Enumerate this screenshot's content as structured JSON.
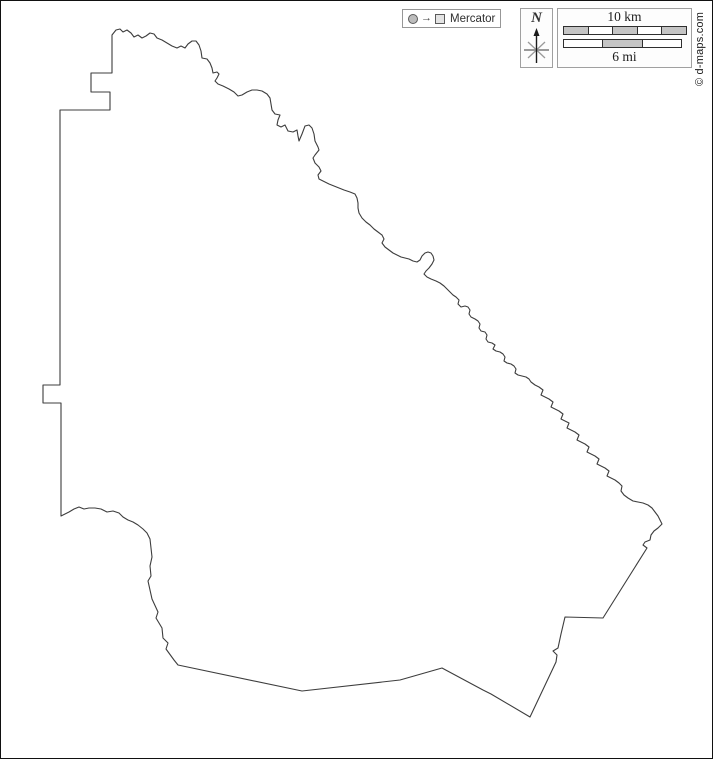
{
  "legend": {
    "projection": "Mercator",
    "arrow_glyph": "→"
  },
  "compass": {
    "label": "N"
  },
  "scale": {
    "km_label": "10 km",
    "mi_label": "6 mi",
    "km_segments": [
      "#c4c4c4",
      "#ffffff",
      "#c4c4c4",
      "#ffffff",
      "#c4c4c4"
    ],
    "mi_segments": [
      "#ffffff",
      "#c4c4c4",
      "#ffffff"
    ]
  },
  "copyright": "© d-maps.com",
  "colors": {
    "outline": "#3d3d3d",
    "frame": "#111111",
    "box_border": "#a0a0a0"
  },
  "map": {
    "outline_points": "112,35 116,30 120,29 123,32 127,30 131,33 134,37 138,35 142,38 146,36 150,33 154,34 157,38 162,40 167,43 172,46 177,48 181,46 185,48 188,44 192,41 196,41 199,45 201,51 202,58 207,59 210,63 212,68 213,73 217,72 219,74 217,78 215,81 218,84 223,86 229,89 234,92 238,96 242,95 247,92 252,90 257,90 262,91 267,94 270,98 271,104 272,110 275,114 280,115 278,120 277,125 281,127 285,125 288,131 293,132 297,130 298,136 299,141 302,134 305,126 309,125 312,128 314,134 315,141 318,147 319,150 315,155 313,158 315,163 319,167 321,171 318,175 319,179 323,181 329,184 334,186 339,188 344,190 350,192 355,194 357,198 358,203 358,208 359,213 362,218 366,222 370,225 374,229 378,232 382,235 384,239 382,243 385,247 389,250 393,253 397,255 401,257 405,258 409,259 413,261 417,262 420,260 422,256 425,253 428,252 431,253 433,256 434,260 432,264 429,268 426,271 424,274 427,277 431,279 436,281 440,283 444,286 447,289 450,292 453,295 456,297 459,300 458,304 461,307 465,306 468,307 470,310 469,314 471,317 475,319 478,321 480,324 479,328 481,331 485,332 487,335 486,339 488,342 492,343 495,345 493,349 496,351 500,352 503,354 505,357 504,361 507,363 511,364 514,366 516,369 515,373 518,375 522,376 526,377 529,379 531,382 535,385 539,387 543,390 541,395 545,397 549,399 553,402 551,407 555,409 559,411 563,414 561,419 565,421 569,423 567,428 571,430 575,432 579,435 577,440 581,442 585,444 589,447 587,452 591,454 595,456 599,459 597,464 601,466 605,468 609,471 607,476 611,478 615,480 619,483 622,486 621,491 624,495 628,498 633,501 638,502 643,503 648,505 652,508 655,512 658,516 660,520 662,524 658,528 654,531 651,535 650,540 645,542 643,545 647,548 603,618 565,617 561,634 558,648 553,651 557,655 556,662 530,717 491,694 483,690 442,668 400,680 302,691 178,665 174,660 166,649 168,643 163,638 162,628 156,618 158,612 152,599 150,590 148,581 151,576 150,566 152,557 151,548 150,539 147,533 143,529 138,525 133,522 128,520 123,517 119,513 113,511 107,512 101,509 95,508 89,508 84,509 79,507 74,509 69,512 65,514 61,516 61,403 43,403 43,385 60,385 60,110 110,110 110,92 91,92 91,73 112,73"
  }
}
